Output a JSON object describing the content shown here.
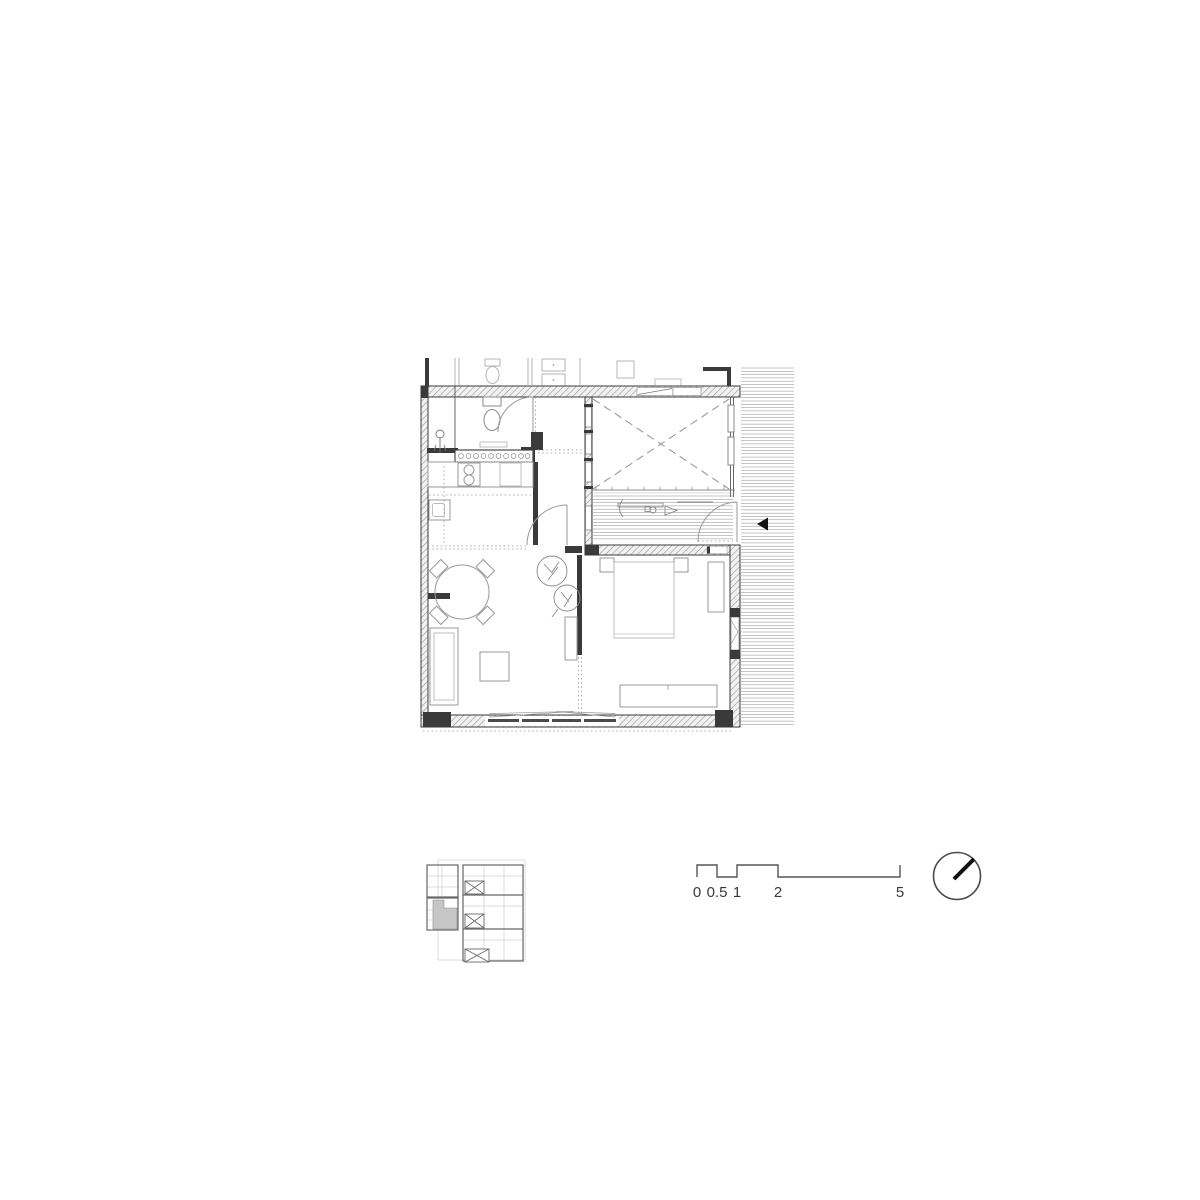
{
  "document": {
    "kind": "architectural floor plan sheet",
    "background": "#ffffff"
  },
  "scale_bar": {
    "labels": [
      "0",
      "0.5",
      "1",
      "2",
      "5"
    ]
  },
  "icons": {
    "north_indicator": "north-arrow-icon",
    "entry_marker": "entry-arrow-icon"
  },
  "colors": {
    "wall_line": "#3a3a3a",
    "hatch_line": "#8f8f8f",
    "furniture_line": "#9a9a9a",
    "light_line": "#b5b5b5",
    "highlight_fill": "#c6c6c6",
    "arrow_fill": "#141414",
    "text": "#3a3a3a"
  }
}
